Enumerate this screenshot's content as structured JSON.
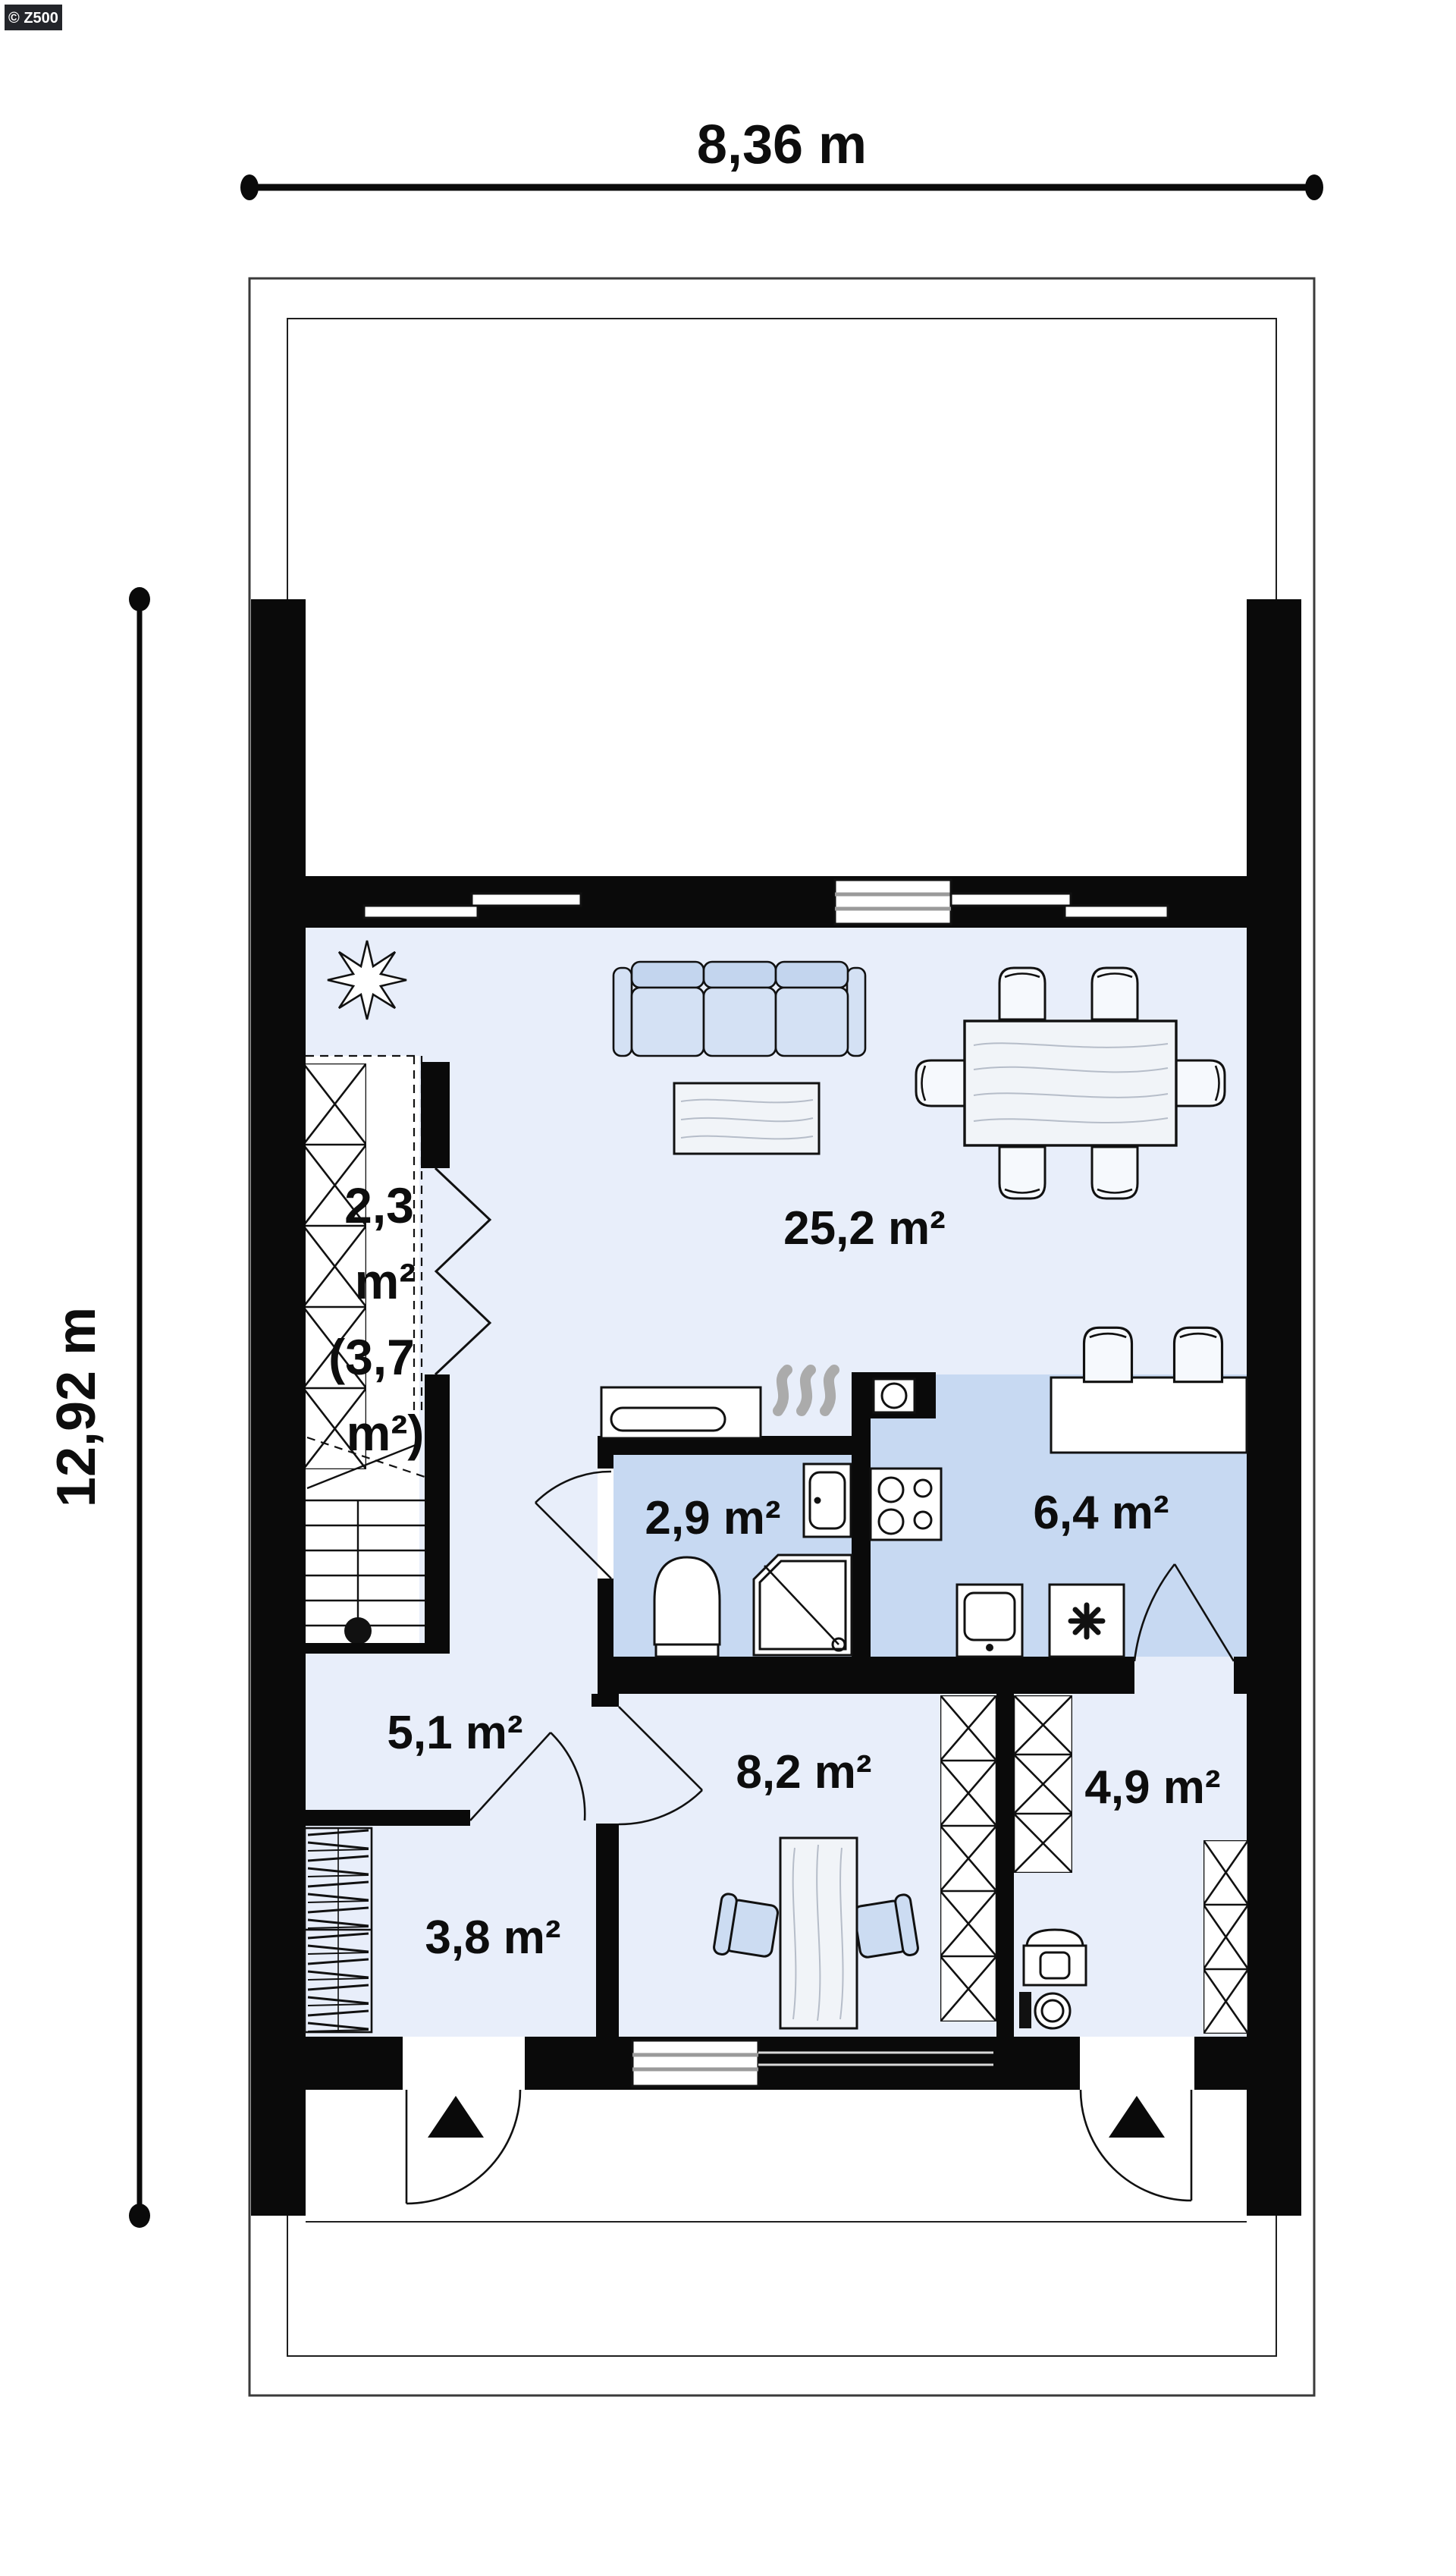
{
  "meta": {
    "copyright": "© Z500"
  },
  "dimensions": {
    "width_label": "8,36 m",
    "height_label": "12,92 m"
  },
  "rooms": {
    "living": "25,2 m²",
    "kitchen": "6,4 m²",
    "bathroom": "2,9 m²",
    "hall": "5,1 m²",
    "office": "8,2 m²",
    "entry": "4,9 m²",
    "storage": "3,8 m²",
    "stairs_l1": "2,3",
    "stairs_l2": "m²",
    "stairs_l3": "(3,7",
    "stairs_l4": "m²)"
  },
  "colors": {
    "wall": "#0a0a0a",
    "floor_light": "#e8eefa",
    "floor_dark": "#c7d9f2",
    "sofa_light": "#d4e1f4",
    "sofa_dark": "#c3d5ee",
    "furn_blue": "#ccdcf2",
    "table_fill": "#f1f4f8",
    "wood_line": "#b6bdc9",
    "flame_grey": "#ababab",
    "glazing_grey": "#9a9a9a",
    "badge_bg": "#23252a"
  }
}
